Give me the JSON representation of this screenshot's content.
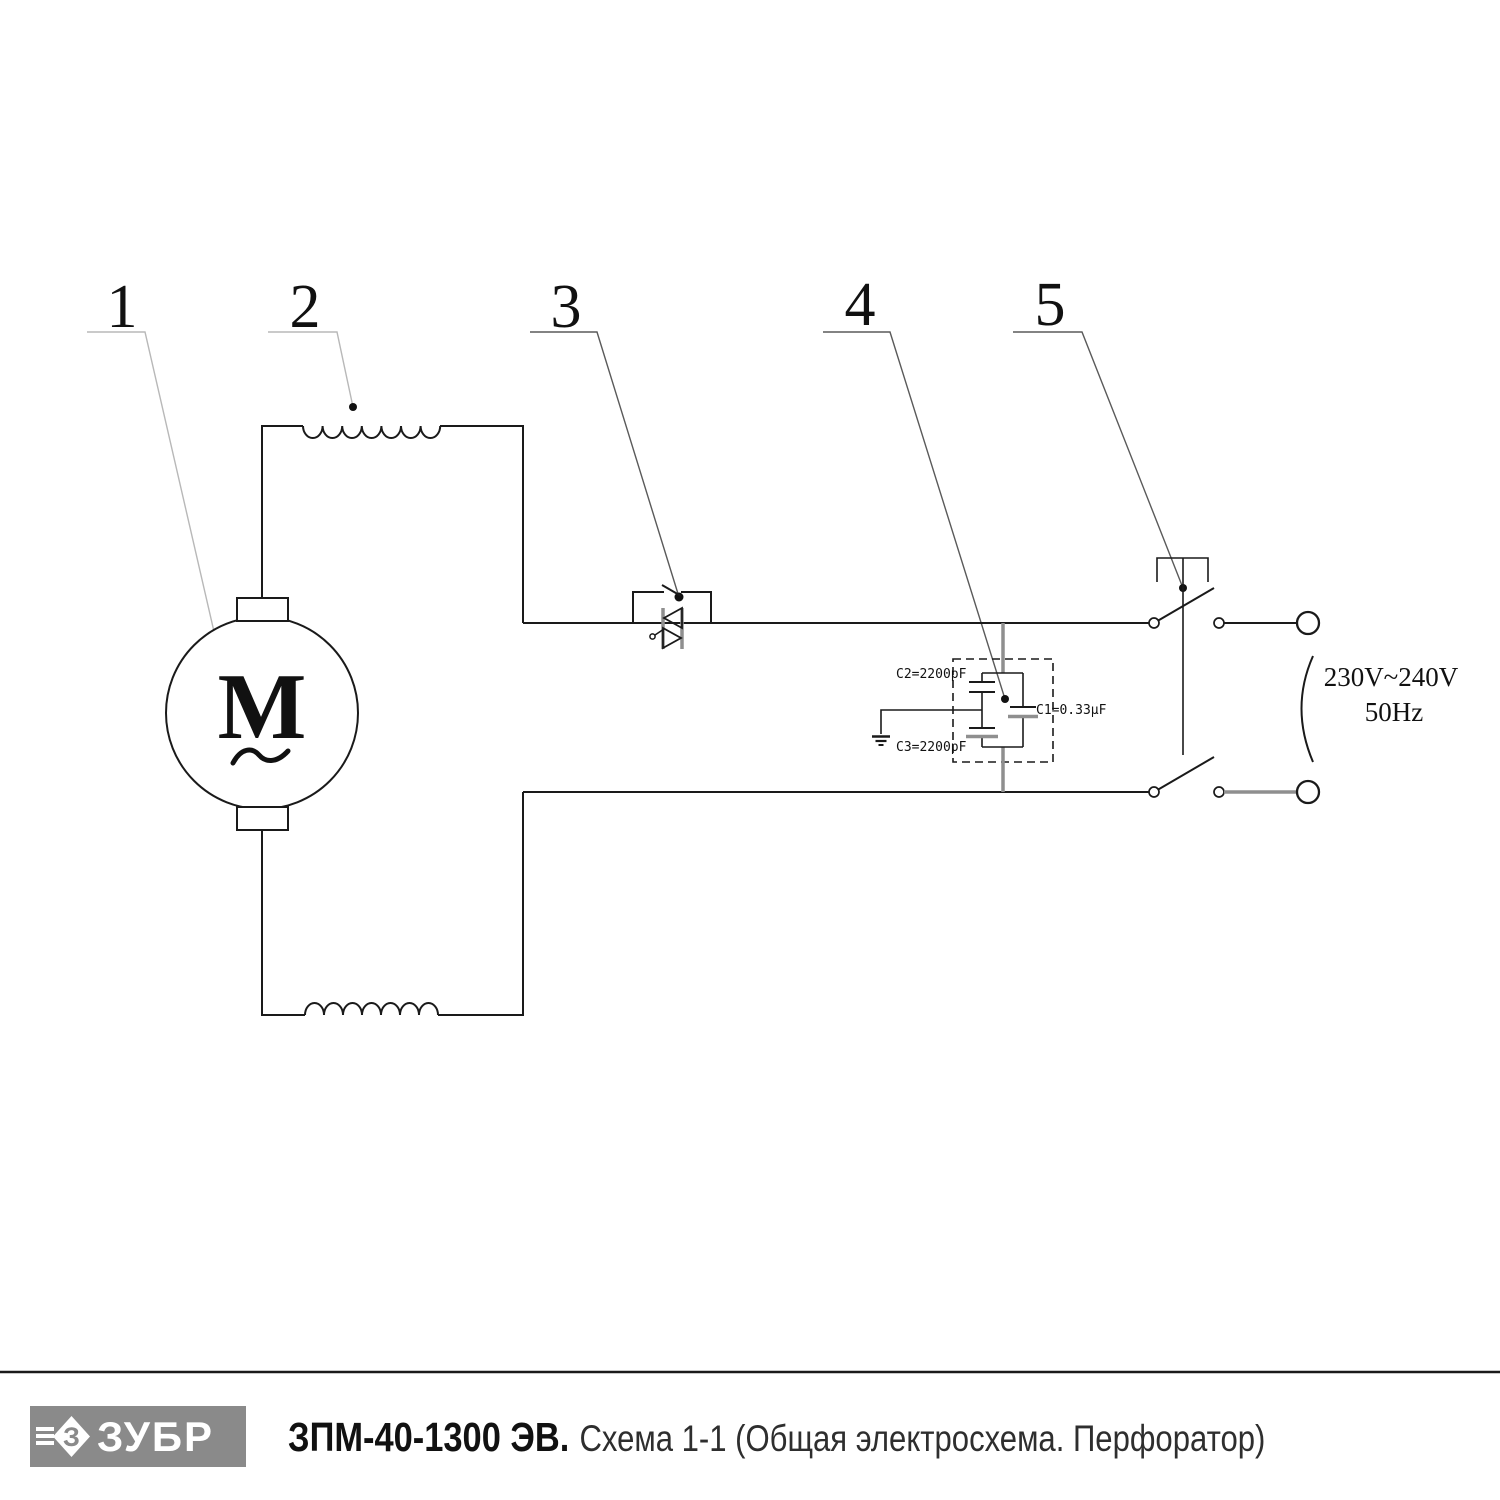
{
  "diagram": {
    "callouts": [
      {
        "number": "1"
      },
      {
        "number": "2"
      },
      {
        "number": "3"
      },
      {
        "number": "4"
      },
      {
        "number": "5"
      }
    ],
    "motor": {
      "letter": "M"
    },
    "capacitors": {
      "c2_label": "C2=2200pF",
      "c1_label": "C1=0.33µF",
      "c3_label": "C3=2200pF"
    },
    "power": {
      "voltage": "230V~240V",
      "frequency": "50Hz"
    }
  },
  "footer": {
    "logo": {
      "text": "ЗУБР",
      "icon_letter": "З"
    },
    "title_bold": "ЗПМ-40-1300 ЭВ.",
    "title_regular": "Схема 1-1 (Общая электросхема. Перфоратор)"
  },
  "colors": {
    "line": "#1a1a1a",
    "gray_line": "#8f8f8f",
    "leader_light": "#b8b8b8",
    "leader_dark": "#5a5a5a",
    "logo_bg": "#8a8a8a"
  }
}
